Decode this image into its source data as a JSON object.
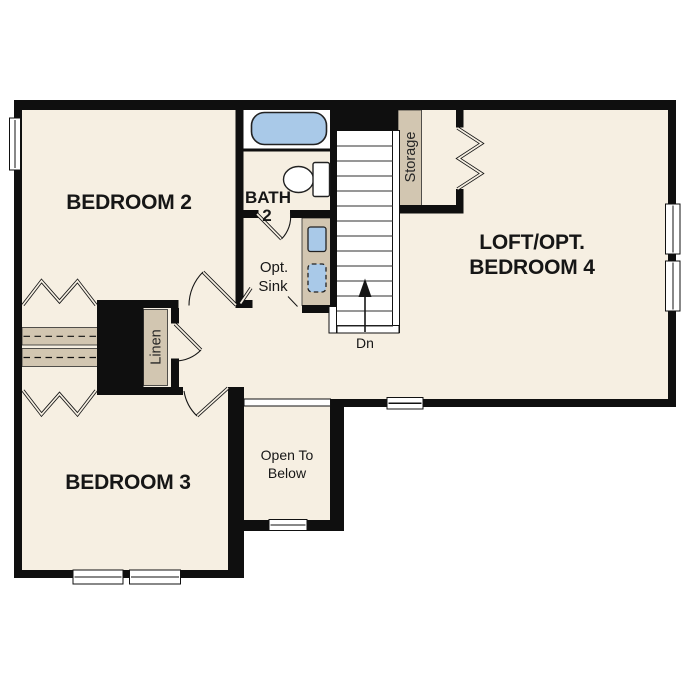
{
  "colors": {
    "wall": "#0f0f0f",
    "floor": "#f6efe2",
    "cabinet": "#d2c6b1",
    "fixture": "#a9c9e8",
    "page": "#ffffff"
  },
  "rooms": {
    "bedroom2": {
      "label": "BEDROOM 2"
    },
    "bath2": {
      "name_line": "BATH",
      "number_line": "2"
    },
    "loft": {
      "line1": "LOFT/OPT.",
      "line2": "BEDROOM 4"
    },
    "bedroom3": {
      "label": "BEDROOM 3"
    },
    "open_to_below": {
      "line1": "Open To",
      "line2": "Below"
    }
  },
  "features": {
    "storage_label": "Storage",
    "linen_label": "Linen",
    "opt_sink_line1": "Opt.",
    "opt_sink_line2": "Sink",
    "stairs_down_label": "Dn"
  }
}
